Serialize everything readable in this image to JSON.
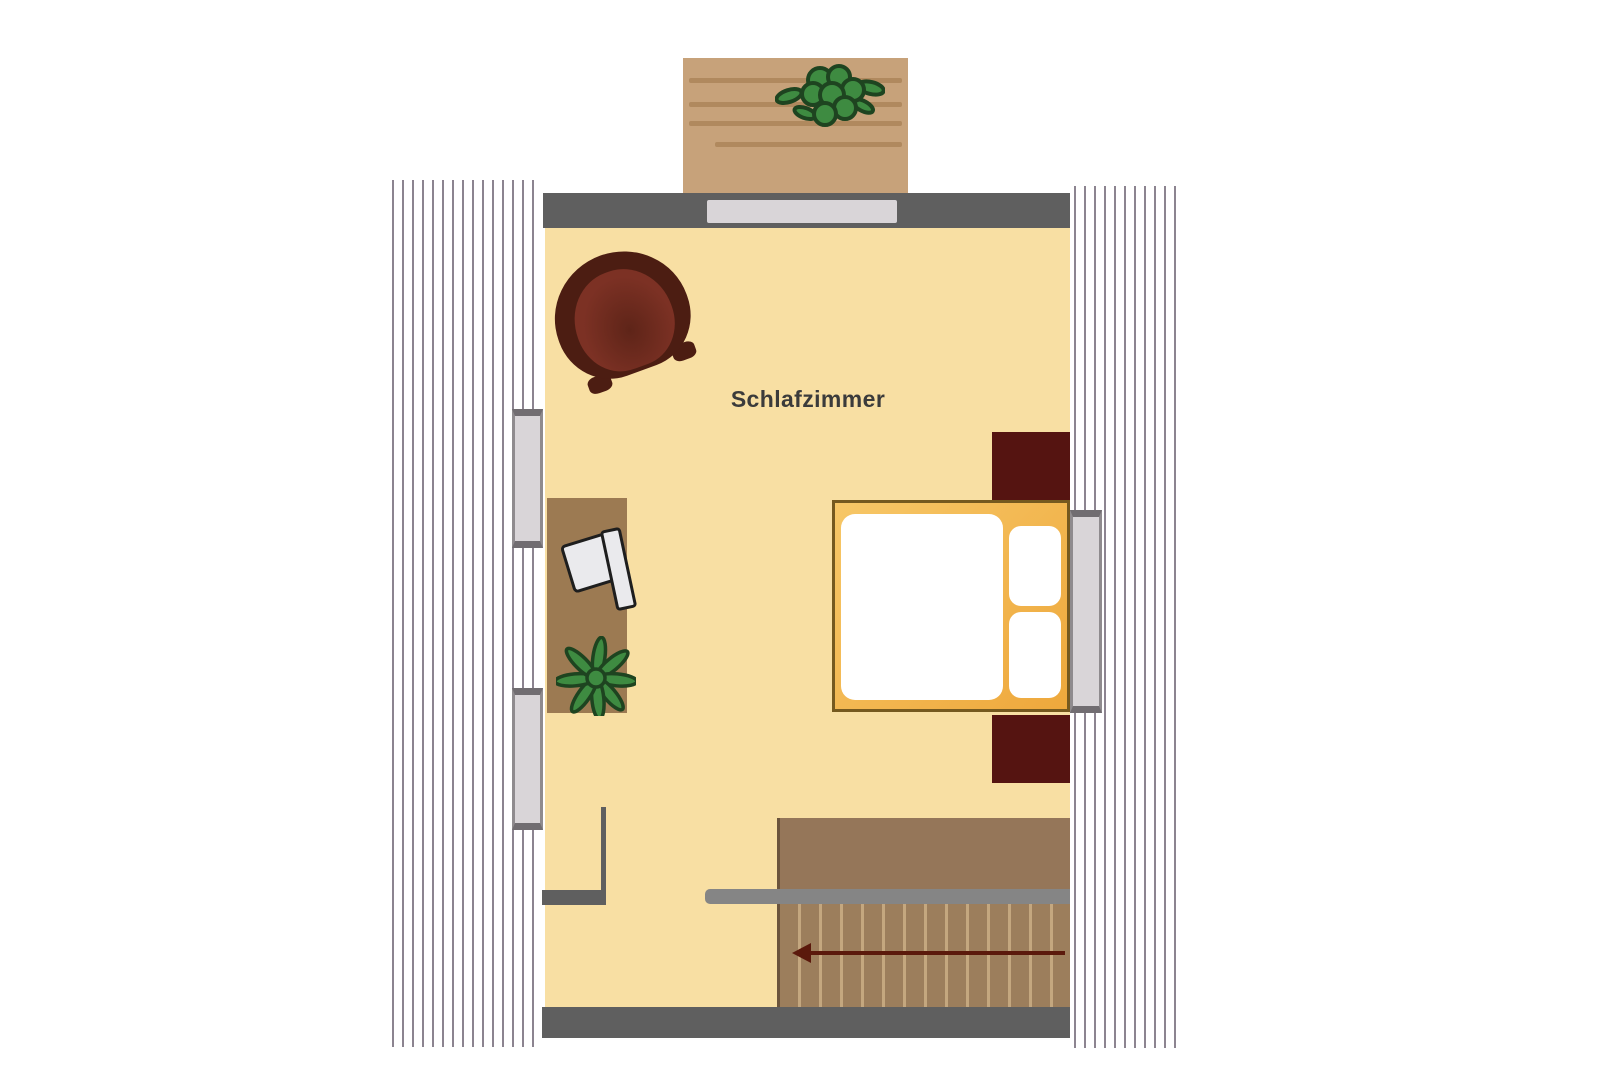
{
  "floorplan": {
    "room_label": "Schlafzimmer",
    "arrow_direction": "left",
    "colors": {
      "background": "#ffffff",
      "floor": "#F8DFA3",
      "wall": "#5F5F5F",
      "hatch_stripe": "#8C8490",
      "window_body": "#D9D5D8",
      "window_frame": "#716D71",
      "window_edge": "#8F8B8E",
      "balcony_deck": "#C7A27A",
      "deck_line": "#B0895E",
      "furniture_brown": "#9C7A52",
      "stairs_upper": "#957659",
      "stairs_lower": "#9C7E5C",
      "stairs_edge": "#6B543C",
      "step_line": "#C4A77F",
      "railing": "#858585",
      "maroon": "#551411",
      "armchair_outer": "#4C1D12",
      "armchair_cushion": "#7C3124",
      "armchair_cushion_dark": "#5E2418",
      "bed_frame_light": "#F7C767",
      "bed_frame_dark": "#EEA83C",
      "bed_frame_border": "#75591F",
      "bedding": "#FFFFFF",
      "chair_fill": "#EAEAED",
      "chair_outline": "#1E1E1E",
      "plant_fill": "#3E8B41",
      "plant_outline": "#1E4420",
      "arrow": "#5B190C",
      "label_text": "#3B3B3B"
    }
  }
}
